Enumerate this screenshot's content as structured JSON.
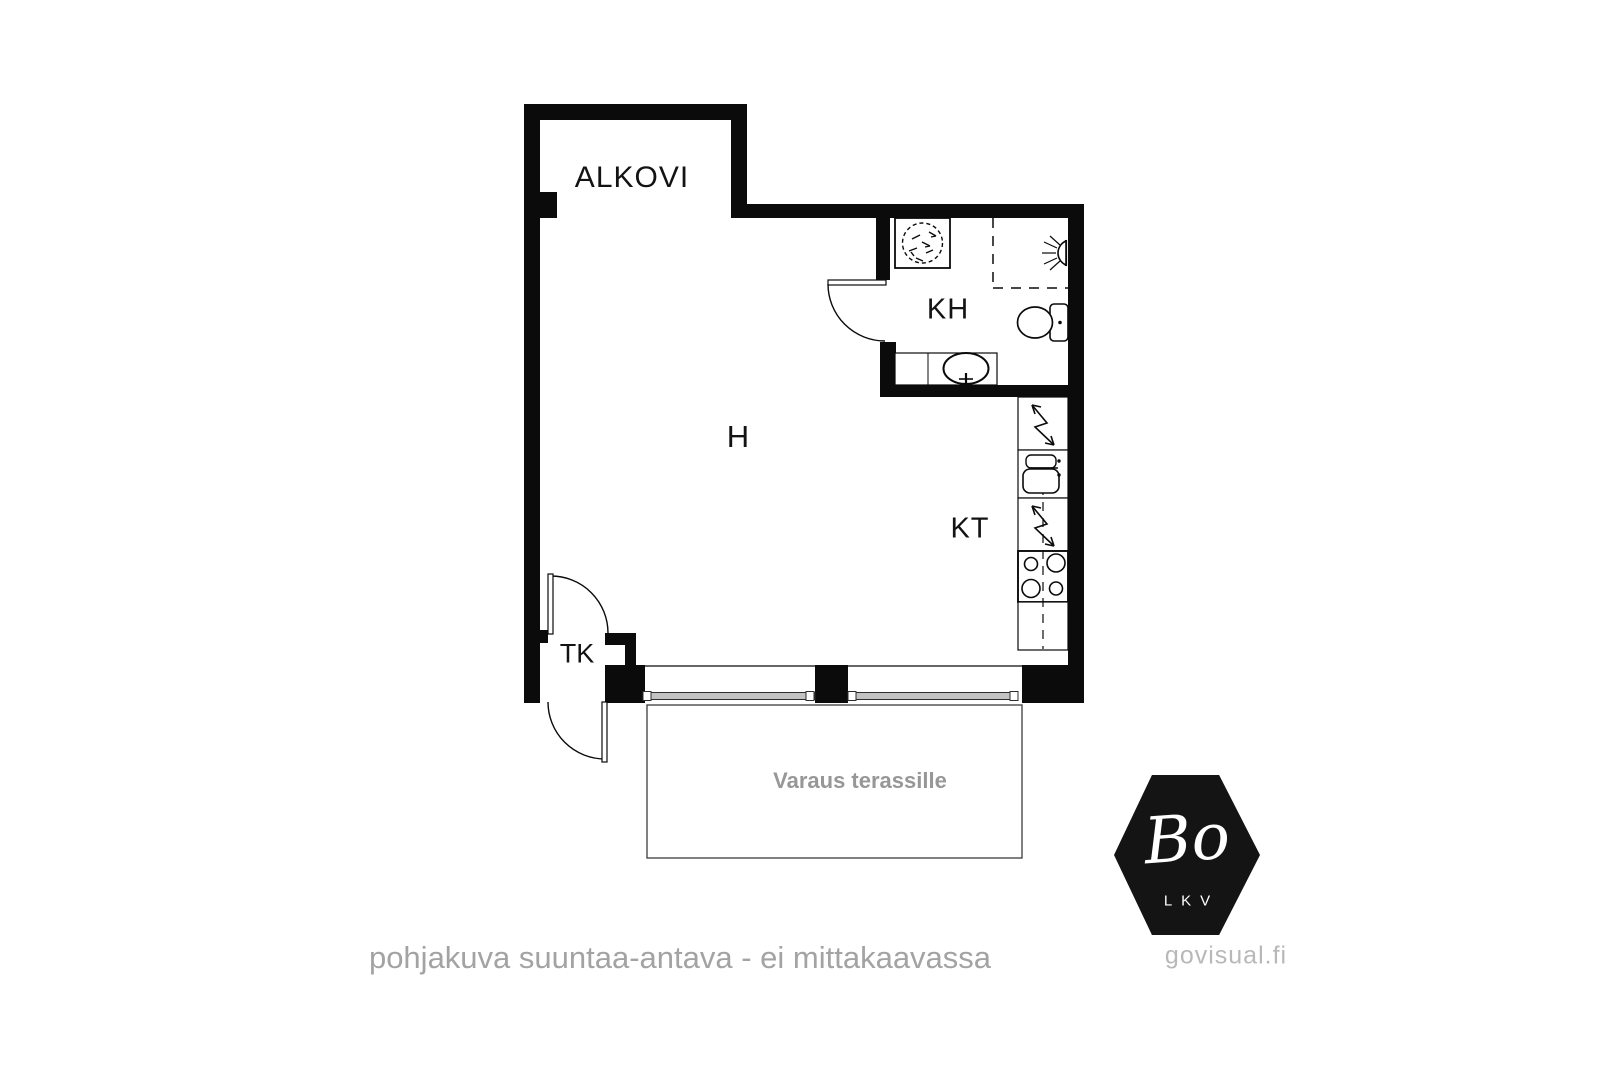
{
  "floorplan": {
    "room_labels": {
      "alkovi": "ALKOVI",
      "kh": "KH",
      "h": "H",
      "kt": "KT",
      "tk": "TK"
    },
    "terrace": {
      "label": "Varaus terassille"
    },
    "footer": {
      "disclaimer": "pohjakuva suuntaa-antava - ei mittakaavassa",
      "watermark": "govisual.fi"
    },
    "logo": {
      "main": "Bo",
      "sub": "LKV"
    },
    "colors": {
      "wall": "#0b0b0b",
      "room_label": "#131313",
      "muted_text": "#979797",
      "disclaimer_text": "#a3a3a3",
      "watermark_text": "#b8b8b8",
      "window_glass": "#c3c3c3",
      "terrace_outline": "#3c3c3c"
    }
  }
}
